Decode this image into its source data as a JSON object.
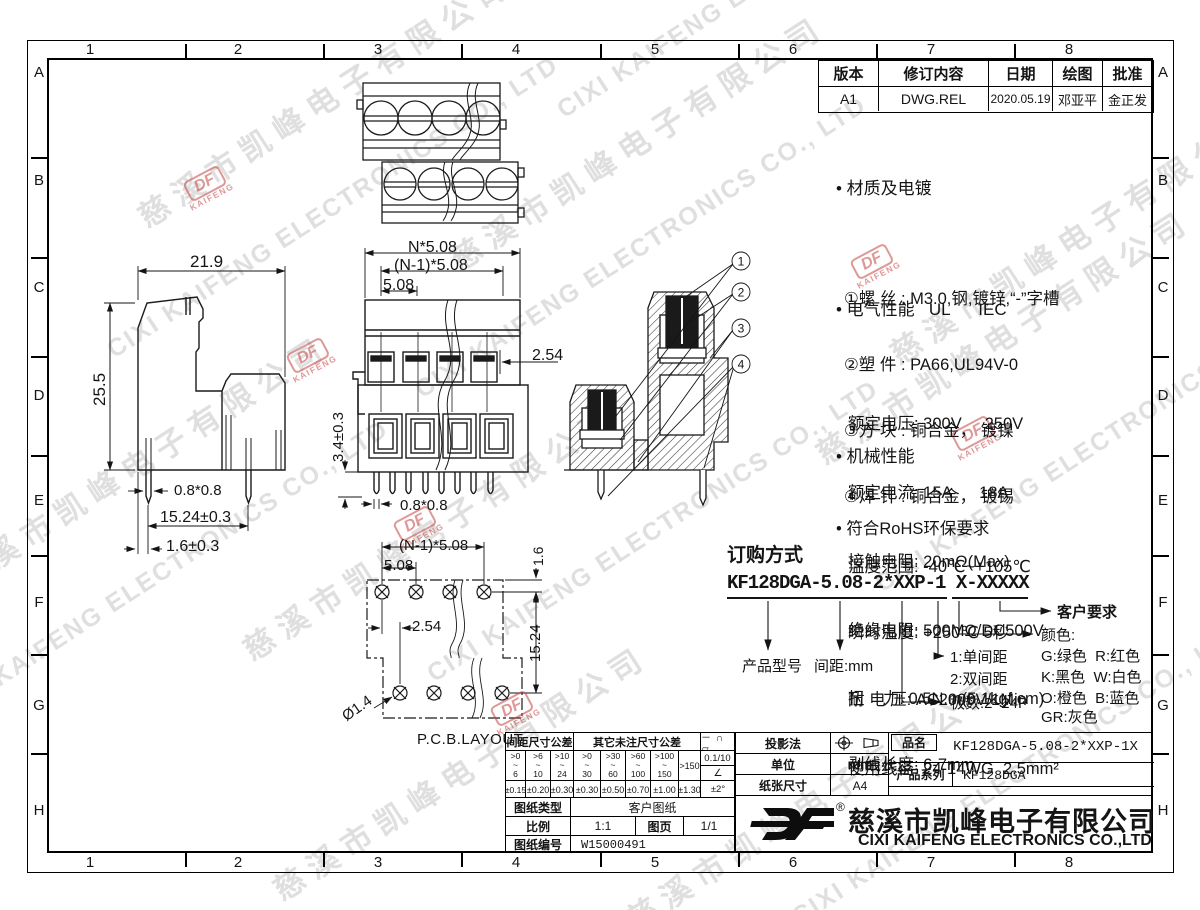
{
  "border": {
    "cols": [
      "1",
      "2",
      "3",
      "4",
      "5",
      "6",
      "7",
      "8"
    ],
    "rows": [
      "A",
      "B",
      "C",
      "D",
      "E",
      "F",
      "G",
      "H"
    ]
  },
  "revision": {
    "headers": [
      "版本",
      "修订内容",
      "日期",
      "绘图",
      "批准"
    ],
    "row": [
      "A1",
      "DWG.REL",
      "2020.05.19",
      "邓亚平",
      "金正发"
    ]
  },
  "notes": {
    "material_title": "• 材质及电镀",
    "material_lines": [
      "①螺 丝 : M3.0,钢,镀锌,“-”字槽",
      "②塑 件 : PA66,UL94V-0",
      "③方 块 : 铜合金， 镀镍",
      "④焊 针 : 铜合金， 镀锡"
    ],
    "electrical_title": "• 电气性能   UL      IEC",
    "electrical_lines": [
      "额定电压: 300V     250V",
      "额定电流: 15A      18A",
      "接触电阻: 20mΩ(Max)",
      "绝缘电阻: 500MΩ/DC500V",
      "耐 电 压: AC2000V/1Min",
      "使用线径: 24-14WG  2.5mm²"
    ],
    "mechanical_title": "• 机械性能",
    "mechanical_lines": [
      "温度范围: -40℃~+105℃",
      "瞬时温度: +250℃ 5秒",
      "扭    力: 0.5N.m(5.1kgf.cm)",
      "剥线长度: 6-7mm"
    ],
    "rohs": "• 符合RoHS环保要求"
  },
  "ordering": {
    "title": "订购方式",
    "part_number": "KF128DGA-5.08-2*XXP-1 X-XXXXX",
    "model": "产品型号",
    "pitch": "间距:mm",
    "single": "1:单间距",
    "double": "2:双间距",
    "poles": "极数:2~24P",
    "customer": "客户要求",
    "color_title": "颜色:",
    "colors": [
      "G:绿色  R:红色",
      "K:黑色  W:白色",
      "O:橙色  B:蓝色",
      "GR:灰色"
    ]
  },
  "dims": {
    "side_w": "21.9",
    "side_h": "25.5",
    "side_pin": "0.8*0.8",
    "side_pitch": "15.24±0.3",
    "side_edge": "1.6±0.3",
    "front_total": "N*5.08",
    "front_span": "(N-1)*5.08",
    "front_pitch": "5.08",
    "front_offset": "2.54",
    "front_pinlen": "3.4±0.3",
    "front_pin": "0.8*0.8",
    "pcb_span": "(N-1)*5.08",
    "pcb_pitch": "5.08",
    "pcb_offset": "2.54",
    "pcb_edge": "1.6",
    "pcb_row": "15.24",
    "pcb_hole": "Ø1.4",
    "pcb_label": "P.C.B.LAYOUT"
  },
  "balloons": [
    "1",
    "2",
    "3",
    "4"
  ],
  "title_block": {
    "tol_pitch_header": "间距尺寸公差",
    "tol_other_header": "其它未注尺寸公差",
    "range_sep": "~",
    "ranges": [
      {
        "t": ">0",
        "b": "6"
      },
      {
        "t": ">6",
        "b": "10"
      },
      {
        "t": ">10",
        "b": "24"
      },
      {
        "t": ">0",
        "b": "30"
      },
      {
        "t": ">30",
        "b": "60"
      },
      {
        "t": ">60",
        "b": "100"
      },
      {
        "t": ">100",
        "b": "150"
      }
    ],
    "range_last": ">150",
    "values": [
      "±0.15",
      "±0.20",
      "±0.30",
      "±0.30",
      "±0.50",
      "±0.70",
      "±1.00",
      "±1.30"
    ],
    "sym_row": "－ ∩ ▱",
    "flat_tol": "0.1/10",
    "angle_sym": "∠",
    "angle_tol": "±2°",
    "projection_label": "投影法",
    "unit_label": "单位",
    "unit_value": "mm",
    "paper_label": "纸张尺寸",
    "paper_value": "A4",
    "pn_label": "品名",
    "pn_value": "KF128DGA-5.08-2*XXP-1X",
    "series_label": "产品系列",
    "series_value": "KF128DGA",
    "doc_type_label": "图纸类型",
    "doc_type_value": "客户图纸",
    "scale_label": "比例",
    "scale_value": "1:1",
    "sheet_label": "图页",
    "sheet_value": "1/1",
    "doc_no_label": "图纸编号",
    "doc_no_value": "W15000491",
    "company_cn": "慈溪市凯峰电子有限公司",
    "company_en": "CIXI KAIFENG ELECTRONICS CO.,LTD",
    "logo_text": "DF",
    "reg_mark": "®"
  },
  "watermark": {
    "cn": "慈溪市凯峰电子有限公司",
    "en": "CIXI KAIFENG ELECTRONICS CO., LTD",
    "logo": "DF",
    "logo_sub": "KAIFENG"
  }
}
